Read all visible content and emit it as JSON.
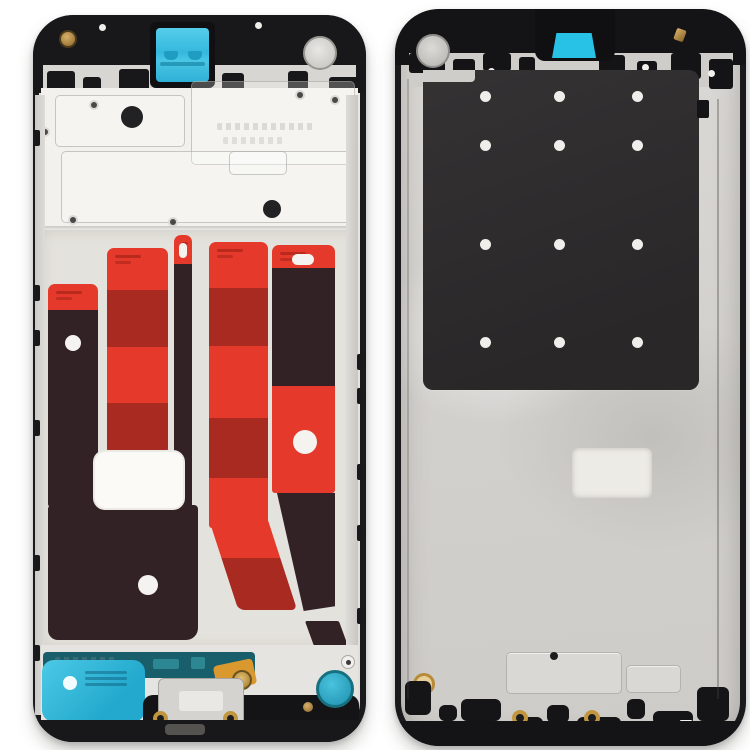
{
  "scene": {
    "type": "product-photo",
    "subject": "smartphone front housing LCD frame bezel pair, inner front view (left) and rear view (right)",
    "background": "#ffffff",
    "visible_text": ""
  },
  "colors": {
    "frame": "#1a1a1c",
    "metal_light": "#f2f1ed",
    "metal_mid": "#dcdad6",
    "metal_dark": "#c6c4c0",
    "panel": "#2e2c2e",
    "red": "#e53a2b",
    "darkred": "#a92a20",
    "maroon": "#332225",
    "cyan": "#38c2e3",
    "cyan_deep": "#1f9dc0",
    "teal": "#195f6b",
    "gold": "#c2963f",
    "white": "#f4f3ef"
  },
  "left_frame": {
    "teeth": [
      [
        14,
        56,
        28,
        22
      ],
      [
        50,
        62,
        18,
        16
      ],
      [
        86,
        54,
        30,
        24
      ],
      [
        122,
        60,
        14,
        14
      ],
      [
        189,
        58,
        22,
        20
      ],
      [
        255,
        56,
        20,
        22
      ],
      [
        296,
        62,
        30,
        16
      ]
    ],
    "strips": [
      {
        "x": 15,
        "w": 50,
        "segments": [
          {
            "y": 269,
            "h": 26,
            "color": "red"
          },
          {
            "y": 295,
            "h": 197,
            "color": "maroon"
          }
        ],
        "dot": {
          "x": 40,
          "y": 328,
          "r": 8
        }
      },
      {
        "x": 74,
        "w": 61,
        "segments": [
          {
            "y": 233,
            "h": 42,
            "color": "red"
          },
          {
            "y": 275,
            "h": 57,
            "color": "darkred"
          },
          {
            "y": 332,
            "h": 56,
            "color": "red"
          },
          {
            "y": 388,
            "h": 49,
            "color": "darkred"
          }
        ]
      },
      {
        "x": 141,
        "w": 18,
        "segments": [
          {
            "y": 220,
            "h": 29,
            "color": "red"
          },
          {
            "y": 249,
            "h": 247,
            "color": "maroon"
          }
        ],
        "pill": {
          "x": 146,
          "y": 228,
          "w": 8,
          "h": 15
        }
      },
      {
        "x": 176,
        "w": 59,
        "segments": [
          {
            "y": 227,
            "h": 46,
            "color": "red"
          },
          {
            "y": 273,
            "h": 58,
            "color": "darkred"
          },
          {
            "y": 331,
            "h": 72,
            "color": "red"
          },
          {
            "y": 403,
            "h": 60,
            "color": "darkred"
          },
          {
            "y": 463,
            "h": 50,
            "color": "red"
          }
        ]
      },
      {
        "x": 239,
        "w": 63,
        "segments": [
          {
            "y": 230,
            "h": 23,
            "color": "red"
          },
          {
            "y": 253,
            "h": 118,
            "color": "maroon"
          },
          {
            "y": 371,
            "h": 107,
            "color": "red"
          }
        ],
        "dot": {
          "x": 272,
          "y": 427,
          "r": 12
        },
        "pill": {
          "x": 259,
          "y": 239,
          "w": 22,
          "h": 11
        }
      }
    ],
    "plate_dots": [
      [
        99,
        102,
        11
      ],
      [
        239,
        194,
        9
      ]
    ],
    "small_holes": [
      [
        12,
        117
      ],
      [
        40,
        205
      ],
      [
        140,
        207
      ],
      [
        267,
        80
      ],
      [
        302,
        85
      ],
      [
        61,
        90
      ]
    ],
    "side_tabs_left": [
      115,
      270,
      315,
      405,
      540,
      630
    ],
    "side_tabs_right": [
      339,
      373,
      449,
      510,
      593
    ],
    "bottom_screws": [
      [
        12,
        640
      ],
      [
        160,
        638
      ],
      [
        308,
        640
      ]
    ]
  },
  "right_frame": {
    "teeth": [
      [
        14,
        44,
        36,
        20
      ],
      [
        58,
        50,
        22,
        26
      ],
      [
        88,
        44,
        28,
        18
      ],
      [
        124,
        48,
        16,
        22
      ],
      [
        204,
        46,
        26,
        24
      ],
      [
        242,
        52,
        20,
        18
      ],
      [
        276,
        44,
        30,
        26
      ],
      [
        314,
        50,
        24,
        30
      ]
    ],
    "rim_dots": [
      [
        96,
        62
      ],
      [
        250,
        58
      ],
      [
        316,
        64
      ]
    ],
    "dot_grid": {
      "cols": [
        90,
        164,
        242
      ],
      "rows": [
        87,
        136,
        235,
        333
      ],
      "r": 5.5
    },
    "embossed": [
      [
        111,
        643,
        114,
        40
      ],
      [
        231,
        656,
        53,
        26
      ]
    ],
    "clips": [
      [
        10,
        672,
        26,
        34
      ],
      [
        44,
        696,
        18,
        16
      ],
      [
        66,
        690,
        40,
        22
      ],
      [
        118,
        708,
        30,
        12
      ],
      [
        152,
        696,
        22,
        18
      ],
      [
        182,
        708,
        44,
        12
      ],
      [
        232,
        690,
        18,
        20
      ],
      [
        258,
        702,
        40,
        14
      ],
      [
        302,
        678,
        32,
        34
      ]
    ],
    "gold_screws": [
      [
        125,
        709
      ],
      [
        197,
        709
      ]
    ]
  }
}
